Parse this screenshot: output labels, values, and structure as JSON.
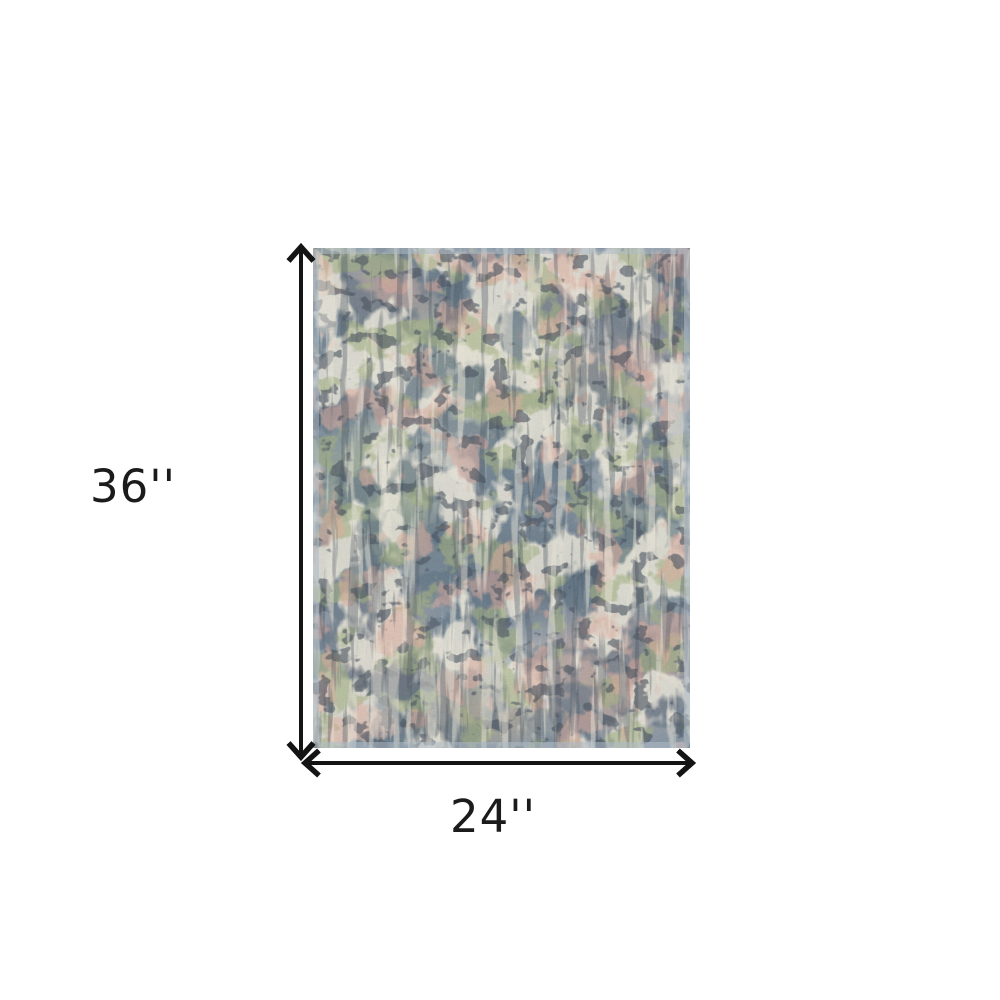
{
  "diagram": {
    "height_label": "36''",
    "width_label": "24''",
    "arrow_color": "#141414",
    "background_color": "#ffffff"
  },
  "rug": {
    "name": "abstract-area-rug-swatch",
    "palette": {
      "base": "#8696a4",
      "edge": "#aebcc6",
      "slate_dark": "#5d7181",
      "charcoal": "#45505c",
      "cream": "#ede9dc",
      "green": "#a4b183",
      "pink": "#dfae9f"
    }
  }
}
